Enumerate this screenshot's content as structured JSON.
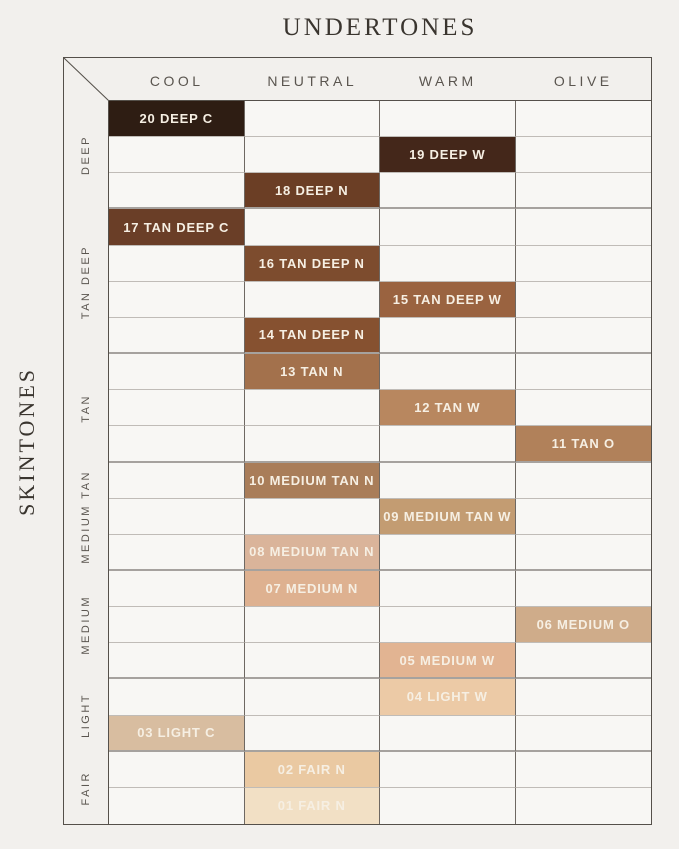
{
  "title": "UNDERTONES",
  "side_title": "SKINTONES",
  "columns": [
    "COOL",
    "NEUTRAL",
    "WARM",
    "OLIVE"
  ],
  "row_groups": [
    {
      "label": "DEEP",
      "rows": 3
    },
    {
      "label": "TAN DEEP",
      "rows": 4
    },
    {
      "label": "TAN",
      "rows": 3
    },
    {
      "label": "MEDIUM TAN",
      "rows": 3
    },
    {
      "label": "MEDIUM",
      "rows": 3
    },
    {
      "label": "LIGHT",
      "rows": 2
    },
    {
      "label": "FAIR",
      "rows": 2
    }
  ],
  "chart_data": {
    "type": "table",
    "title": "UNDERTONES",
    "row_axis_label": "SKINTONES",
    "col_axis_label": "UNDERTONES",
    "x_categories": [
      "COOL",
      "NEUTRAL",
      "WARM",
      "OLIVE"
    ],
    "y_groups": [
      "DEEP",
      "TAN DEEP",
      "TAN",
      "MEDIUM TAN",
      "MEDIUM",
      "LIGHT",
      "FAIR"
    ],
    "cells": [
      {
        "row": 1,
        "col": 0,
        "label": "20 DEEP C",
        "undertone": "COOL",
        "skintone": "DEEP",
        "color": "#2e1d13"
      },
      {
        "row": 2,
        "col": 2,
        "label": "19 DEEP W",
        "undertone": "WARM",
        "skintone": "DEEP",
        "color": "#44271a"
      },
      {
        "row": 3,
        "col": 1,
        "label": "18 DEEP N",
        "undertone": "NEUTRAL",
        "skintone": "DEEP",
        "color": "#6b3e25"
      },
      {
        "row": 4,
        "col": 0,
        "label": "17 TAN DEEP C",
        "undertone": "COOL",
        "skintone": "TAN DEEP",
        "color": "#6a3e27"
      },
      {
        "row": 5,
        "col": 1,
        "label": "16 TAN DEEP N",
        "undertone": "NEUTRAL",
        "skintone": "TAN DEEP",
        "color": "#7d4c2e"
      },
      {
        "row": 6,
        "col": 2,
        "label": "15 TAN DEEP W",
        "undertone": "WARM",
        "skintone": "TAN DEEP",
        "color": "#9a6340"
      },
      {
        "row": 7,
        "col": 1,
        "label": "14 TAN DEEP N",
        "undertone": "NEUTRAL",
        "skintone": "TAN DEEP",
        "color": "#865130"
      },
      {
        "row": 8,
        "col": 1,
        "label": "13 TAN N",
        "undertone": "NEUTRAL",
        "skintone": "TAN",
        "color": "#a3714c"
      },
      {
        "row": 9,
        "col": 2,
        "label": "12 TAN W",
        "undertone": "WARM",
        "skintone": "TAN",
        "color": "#b8875f"
      },
      {
        "row": 10,
        "col": 3,
        "label": "11 TAN O",
        "undertone": "OLIVE",
        "skintone": "TAN",
        "color": "#b1815a"
      },
      {
        "row": 11,
        "col": 1,
        "label": "10 MEDIUM TAN N",
        "undertone": "NEUTRAL",
        "skintone": "MEDIUM TAN",
        "color": "#a97d59"
      },
      {
        "row": 12,
        "col": 2,
        "label": "09 MEDIUM TAN W",
        "undertone": "WARM",
        "skintone": "MEDIUM TAN",
        "color": "#c39c72"
      },
      {
        "row": 13,
        "col": 1,
        "label": "08 MEDIUM TAN N",
        "undertone": "NEUTRAL",
        "skintone": "MEDIUM TAN",
        "color": "#dab49a"
      },
      {
        "row": 14,
        "col": 1,
        "label": "07 MEDIUM N",
        "undertone": "NEUTRAL",
        "skintone": "MEDIUM",
        "color": "#deb190"
      },
      {
        "row": 15,
        "col": 3,
        "label": "06 MEDIUM O",
        "undertone": "OLIVE",
        "skintone": "MEDIUM",
        "color": "#cfac8a"
      },
      {
        "row": 16,
        "col": 2,
        "label": "05 MEDIUM W",
        "undertone": "WARM",
        "skintone": "MEDIUM",
        "color": "#e2b492"
      },
      {
        "row": 17,
        "col": 2,
        "label": "04 LIGHT W",
        "undertone": "WARM",
        "skintone": "LIGHT",
        "color": "#eccaa6"
      },
      {
        "row": 18,
        "col": 0,
        "label": "03 LIGHT C",
        "undertone": "COOL",
        "skintone": "LIGHT",
        "color": "#d8bda0"
      },
      {
        "row": 19,
        "col": 1,
        "label": "02 FAIR N",
        "undertone": "NEUTRAL",
        "skintone": "FAIR",
        "color": "#eac9a2"
      },
      {
        "row": 20,
        "col": 1,
        "label": "01 FAIR N",
        "undertone": "NEUTRAL",
        "skintone": "FAIR",
        "color": "#f2e0c5"
      }
    ]
  },
  "line_colors": {
    "outer_border": "#55504a",
    "column_line": "#6e6862",
    "row_line": "#c0bcb7",
    "group_line": "#a6a29e"
  }
}
